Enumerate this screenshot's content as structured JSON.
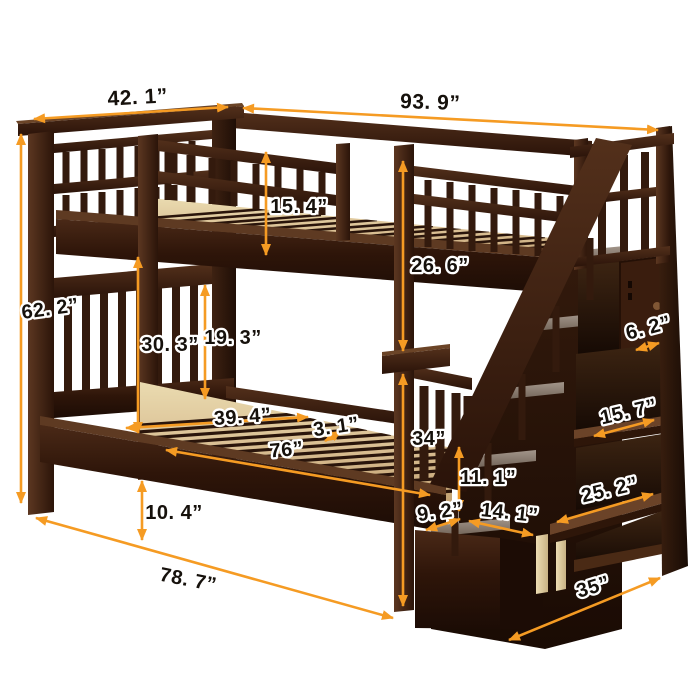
{
  "colors": {
    "background": "#ffffff",
    "arrow_orange": "#f59b23",
    "label_text": "#16110c",
    "label_outline": "#ffffff",
    "wood_dark": "#2b1409",
    "wood_mid": "#3e1f10",
    "wood_light": "#5c3721",
    "slat_tan": "#d9be92",
    "leg_tan": "#e5d2a6",
    "tread_gray": "#8f8175"
  },
  "dimensions": [
    {
      "id": "headboard-width",
      "label": "42. 1”"
    },
    {
      "id": "overall-length-top",
      "label": "93. 9”"
    },
    {
      "id": "guardrail-height",
      "label": "15. 4”"
    },
    {
      "id": "upper-bunk-depth",
      "label": "26. 6”"
    },
    {
      "id": "overall-height",
      "label": "62. 2”"
    },
    {
      "id": "bunk-clearance",
      "label": "30. 3”"
    },
    {
      "id": "lower-headboard-height",
      "label": "19. 3”"
    },
    {
      "id": "slat-span-width",
      "label": "39. 4”"
    },
    {
      "id": "slat-gap",
      "label": "3. 1”"
    },
    {
      "id": "sleeping-length",
      "label": "76”"
    },
    {
      "id": "frame-to-floor",
      "label": "34”"
    },
    {
      "id": "step-rise",
      "label": "11. 1”"
    },
    {
      "id": "step-offset",
      "label": "9. 2”"
    },
    {
      "id": "step-depth",
      "label": "14. 1”"
    },
    {
      "id": "underbed-clearance",
      "label": "10. 4”"
    },
    {
      "id": "base-length",
      "label": "78. 7”"
    },
    {
      "id": "shelf-side-depth",
      "label": "6. 2”"
    },
    {
      "id": "upper-shelf-width",
      "label": "15. 7”"
    },
    {
      "id": "lower-shelf-width",
      "label": "25. 2”"
    },
    {
      "id": "stair-unit-depth",
      "label": "35”"
    }
  ]
}
